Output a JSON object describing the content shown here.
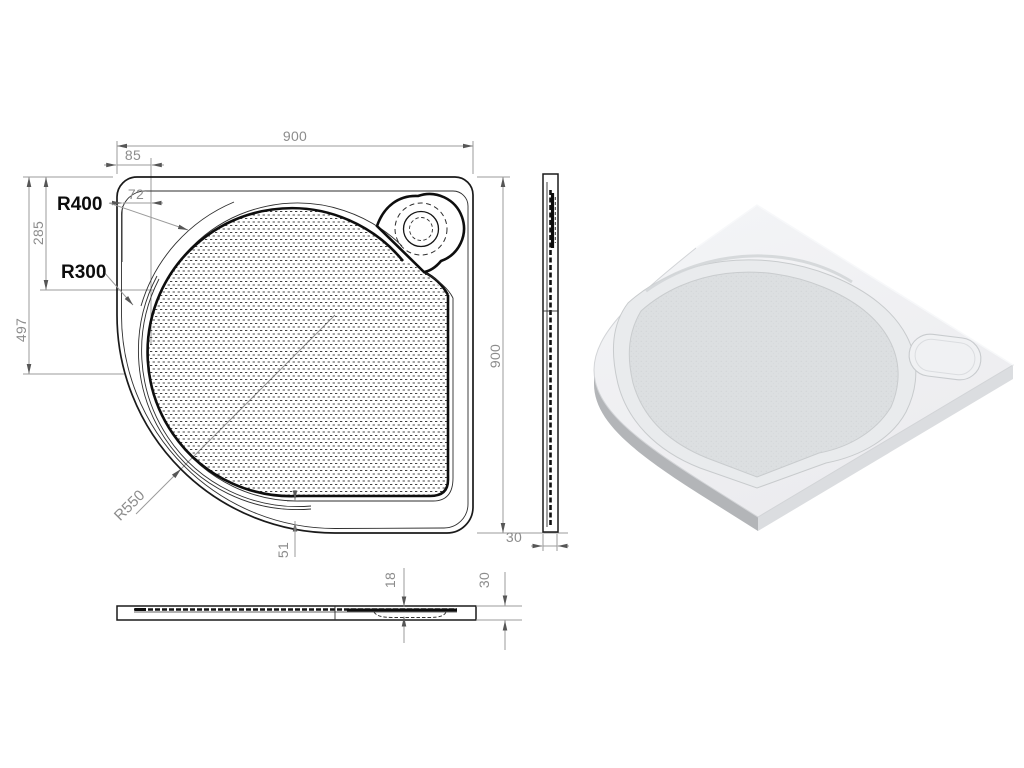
{
  "plan_view": {
    "dim_width_top": "900",
    "dim_height_right": "900",
    "dim_flange_outer": "85",
    "dim_flange_inner": "72",
    "dim_vertical_upper": "285",
    "dim_vertical_lower": "497",
    "dim_bottom_offset": "51",
    "label_radius_outer": "R400",
    "label_radius_inner": "R300",
    "label_radius_corner": "R550"
  },
  "side_view": {
    "dim_thickness": "30"
  },
  "front_view": {
    "dim_basin_depth": "18",
    "dim_edge_height": "30"
  },
  "colors": {
    "ink": "#1a1a1a",
    "dim_line": "#9b9b9b",
    "dim_text": "#8c8c8c",
    "arrow": "#565656",
    "render_surface": "#f1f2f4",
    "render_band": "#e9ebed",
    "render_floor": "#dcdfe1",
    "render_side_shadow": "#b3b5b8",
    "render_right_shadow": "#dbdde0",
    "render_edge": "#c8cbce"
  }
}
